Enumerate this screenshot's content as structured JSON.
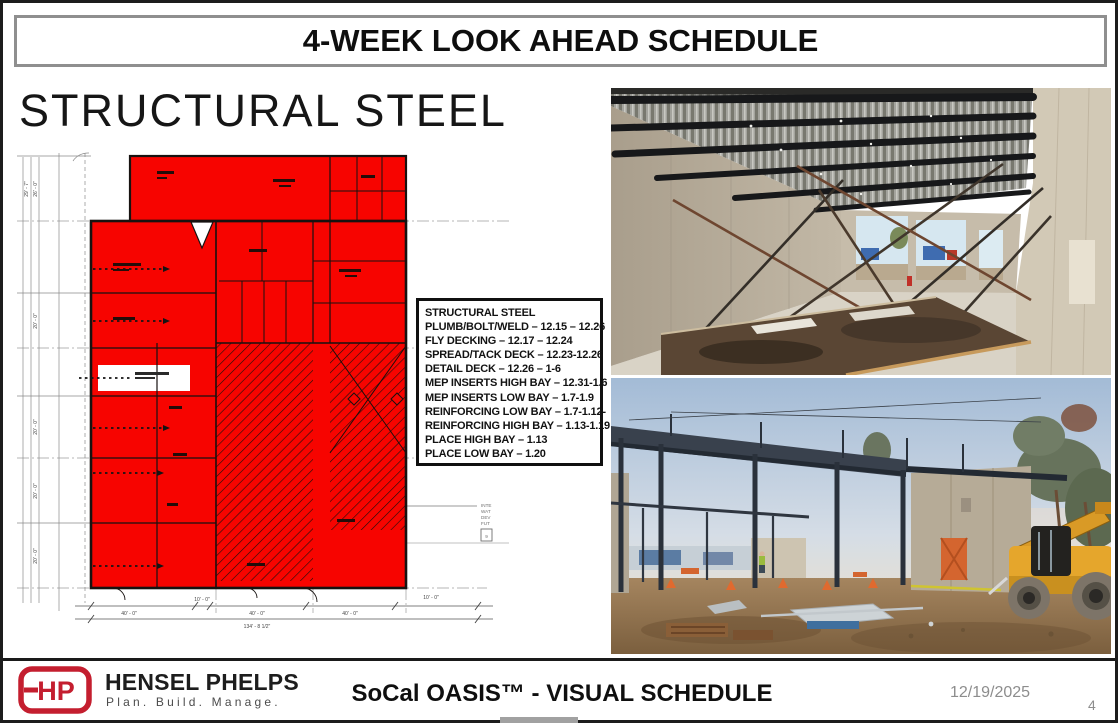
{
  "slide": {
    "title": "4-WEEK LOOK AHEAD SCHEDULE",
    "section_heading": "STRUCTURAL STEEL"
  },
  "schedule_box": {
    "title": "STRUCTURAL STEEL",
    "items": [
      "PLUMB/BOLT/WELD – 12.15 – 12.26",
      "FLY DECKING – 12.17 – 12.24",
      "SPREAD/TACK DECK – 12.23-12.26",
      "DETAIL DECK – 12.26 – 1-6",
      "MEP INSERTS HIGH BAY – 12.31-1.6",
      "MEP INSERTS LOW BAY – 1.7-1.9",
      "REINFORCING LOW BAY – 1.7-1.12-",
      "REINFORCING HIGH BAY – 1.13-1.19",
      "PLACE HIGH BAY – 1.13",
      "PLACE LOW BAY – 1.20"
    ]
  },
  "floor_plan": {
    "highlight_color": "#f70400",
    "bottom_dimensions": [
      "40' - 0\"",
      "10' - 0\"",
      "40' - 0\"",
      "40' - 0\"",
      "10' - 0\""
    ],
    "bottom_total_dimension": "134' - 8 1/2\"",
    "left_dimensions": [
      "29' - 7\"",
      "26' - 0\"",
      "20' - 0\"",
      "20' - 0\"",
      "20' - 0\"",
      "20' - 0\""
    ],
    "side_note_lines": [
      "INTE",
      "WAT",
      "DEV",
      "FUT"
    ],
    "side_note_number": "9"
  },
  "footer": {
    "logo_monogram": "HP",
    "company": "HENSEL PHELPS",
    "tagline": "Plan. Build. Manage.",
    "project_title": "SoCal OASIS™ - VISUAL SCHEDULE",
    "date": "12/19/2025",
    "page": "4"
  }
}
